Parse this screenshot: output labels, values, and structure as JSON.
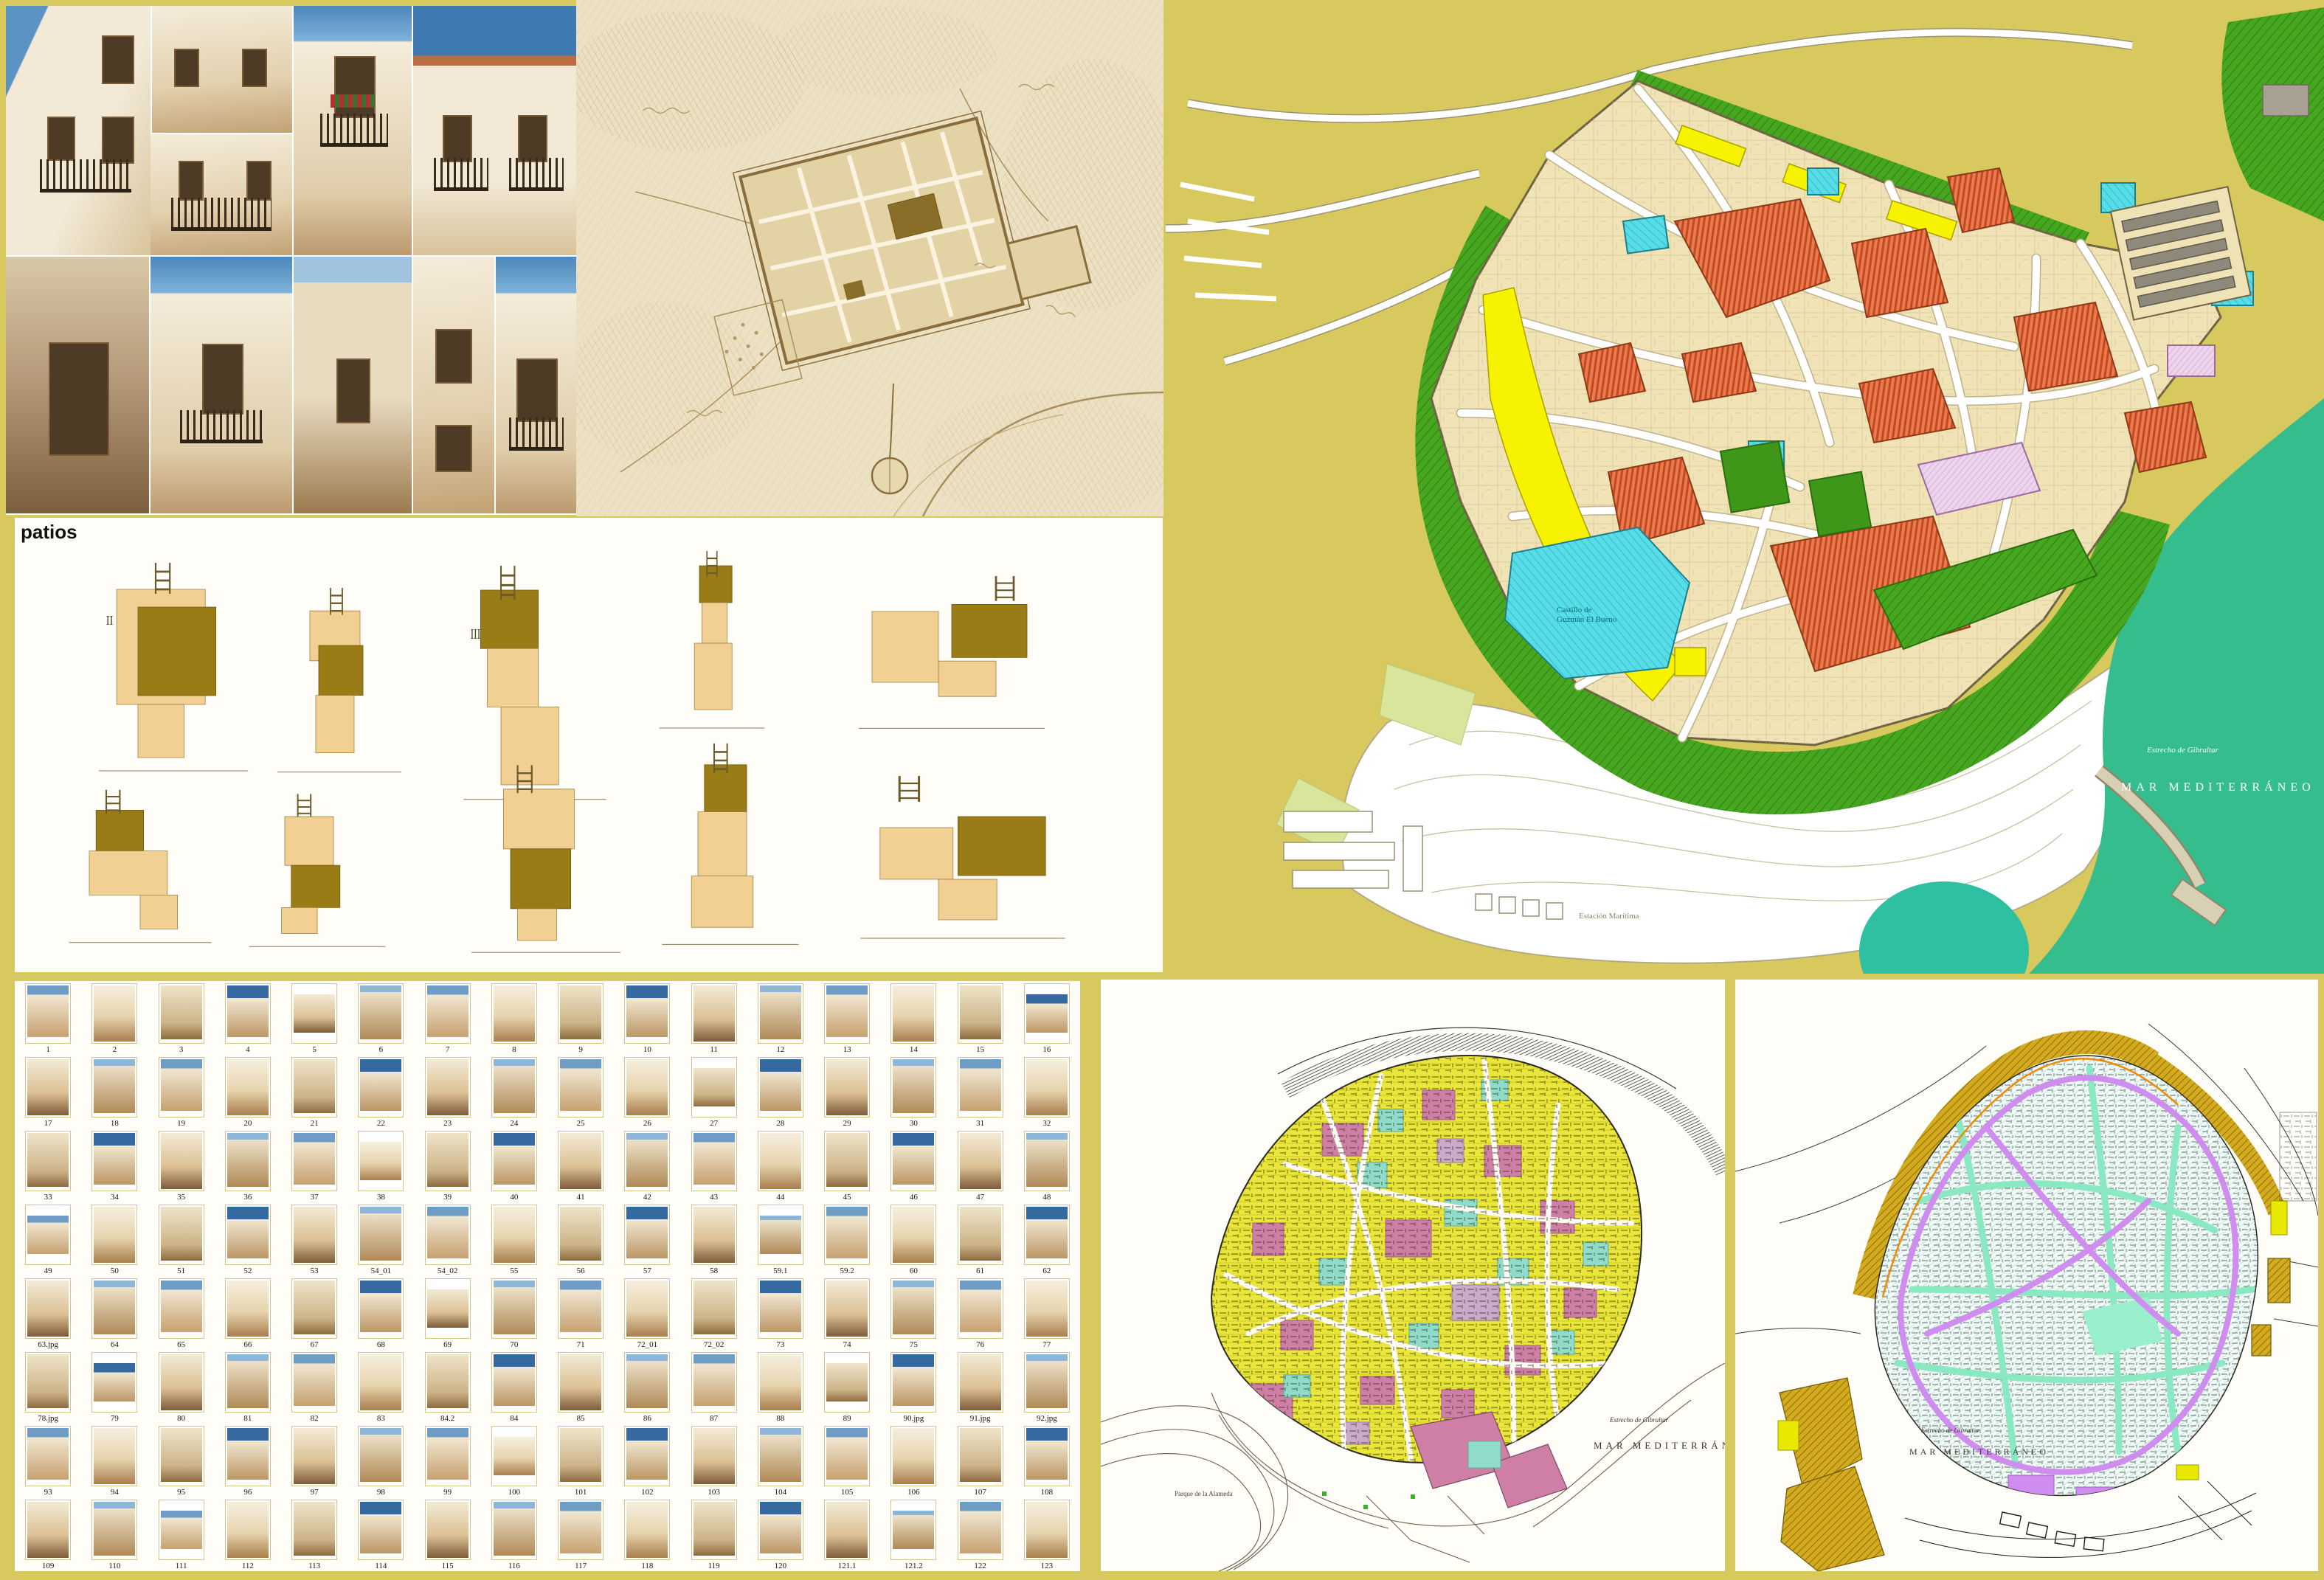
{
  "page": {
    "background_color": "#d8c95f"
  },
  "collage": {
    "sky_color": "#5b93c4",
    "wall_color": "#f2e9d6",
    "description_colors": {
      "shadow": "#c2a274",
      "wood": "#4e3b26"
    }
  },
  "antique_map": {
    "paper_color": "#ece1c2",
    "ink_color": "#8a6d3d"
  },
  "big_plan": {
    "colors": {
      "background": "#d8c95f",
      "parcel_cream": "#f0e3b6",
      "orange": "#ea7a50",
      "green": "#47a61f",
      "cyan": "#58dce6",
      "yellow": "#f7f300",
      "pink": "#ecd4ec",
      "sea": "#36bd8e",
      "street": "#ffffff"
    },
    "labels": {
      "castle_line1": "Castillo de",
      "castle_line2": "Guzmán El Bueno",
      "station": "Estación Marítima",
      "strait": "Estrecho de Gibraltar",
      "sea": "MAR MEDITERRÁNEO"
    }
  },
  "patios": {
    "title": "patios",
    "marks": [
      "II",
      "III"
    ],
    "plan_fill": "#f2cf92",
    "patio_fill": "#9a7c17"
  },
  "thumbnails": {
    "labels": [
      "1",
      "2",
      "3",
      "4",
      "5",
      "6",
      "7",
      "8",
      "9",
      "10",
      "11",
      "12",
      "13",
      "14",
      "15",
      "16",
      "17",
      "18",
      "19",
      "20",
      "21",
      "22",
      "23",
      "24",
      "25",
      "26",
      "27",
      "28",
      "29",
      "30",
      "31",
      "32",
      "33",
      "34",
      "35",
      "36",
      "37",
      "38",
      "39",
      "40",
      "41",
      "42",
      "43",
      "44",
      "45",
      "46",
      "47",
      "48",
      "49",
      "50",
      "51",
      "52",
      "53",
      "54_01",
      "54_02",
      "55",
      "56",
      "57",
      "58",
      "59.1",
      "59.2",
      "60",
      "61",
      "62",
      "63.jpg",
      "64",
      "65",
      "66",
      "67",
      "68",
      "69",
      "70",
      "71",
      "72_01",
      "72_02",
      "73",
      "74",
      "75",
      "76",
      "77",
      "78.jpg",
      "79",
      "80",
      "81",
      "82",
      "83",
      "84.2",
      "84",
      "85",
      "86",
      "87",
      "88",
      "89",
      "90.jpg",
      "91.jpg",
      "92.jpg",
      "93",
      "94",
      "95",
      "96",
      "97",
      "98",
      "99",
      "100",
      "101",
      "102",
      "103",
      "104",
      "105",
      "106",
      "107",
      "108",
      "109",
      "110",
      "111",
      "112",
      "113",
      "114",
      "115",
      "116",
      "117",
      "118",
      "119",
      "120",
      "121.1",
      "121.2",
      "122",
      "123"
    ]
  },
  "plan_middle": {
    "colors": {
      "yellow": "#ebe63a",
      "pink": "#cf7fa5",
      "cyan": "#8fdcca",
      "lavender": "#cbaacb"
    },
    "labels": {
      "park": "Parque de la Alameda",
      "strait": "Estrecho de Gibraltar",
      "sea": "MAR MEDITERRÁNEO"
    }
  },
  "plan_right": {
    "colors": {
      "gold": "#d4ab1e",
      "violet": "#cf8df0",
      "mint": "#8ae9c3",
      "hatch": "#a8ded6"
    },
    "labels": {
      "strait": "Estrecho de Gibraltar",
      "sea": "MAR MEDITERRÁNEO"
    }
  }
}
